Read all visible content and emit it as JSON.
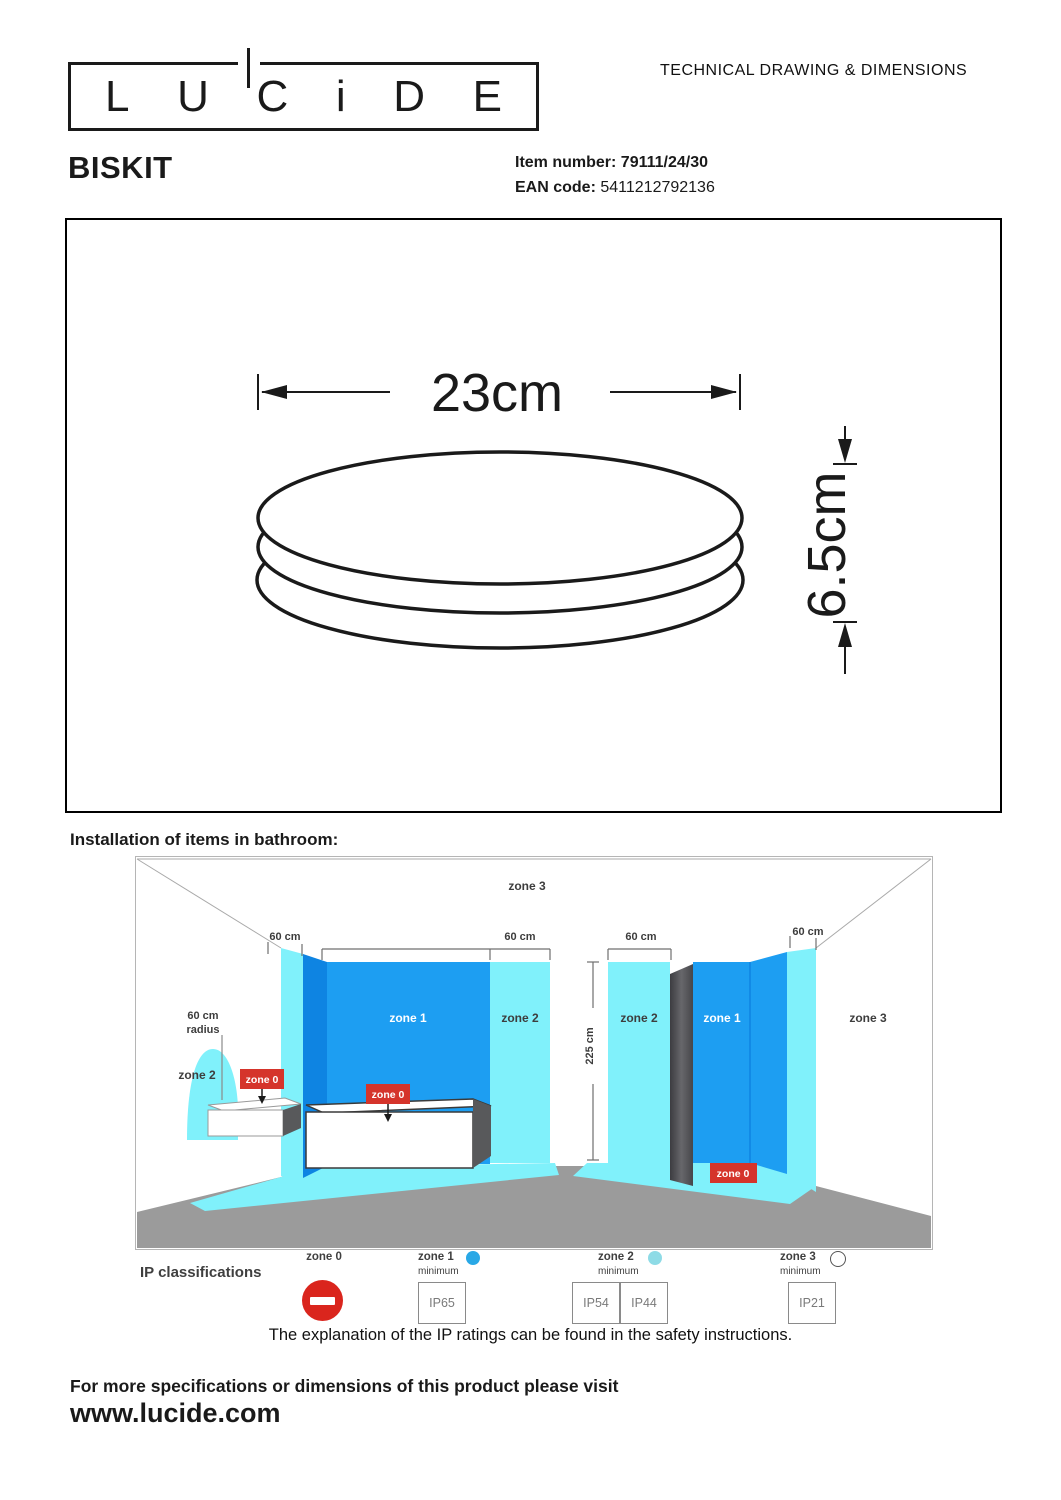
{
  "header": {
    "brand_letters": [
      "L",
      "U",
      "C",
      "i",
      "D",
      "E"
    ],
    "doc_title": "TECHNICAL DRAWING & DIMENSIONS",
    "product_name": "BISKIT",
    "item_number_label": "Item number:",
    "item_number_value": "79111/24/30",
    "ean_label": "EAN code:",
    "ean_value": "5411212792136"
  },
  "drawing": {
    "width_dim": "23cm",
    "height_dim": "6.5cm"
  },
  "bathroom": {
    "section_title": "Installation of items in bathroom:",
    "ceiling_zone": "zone 3",
    "left_wall_dim": "60 cm",
    "tub_zone2_dim": "60 cm",
    "shower_zone2_dim": "60 cm",
    "right_wall_dim": "60 cm",
    "room_height_dim": "225 cm",
    "radius_label_line1": "60 cm",
    "radius_label_line2": "radius",
    "sink_zone": "zone 2",
    "sink_badge": "zone 0",
    "tub_wall_zone": "zone 1",
    "tub_right_zone": "zone 2",
    "tub_badge": "zone 0",
    "shower_left_zone": "zone 2",
    "shower_wall_zone": "zone 1",
    "shower_badge": "zone 0",
    "right_wall_zone": "zone 3"
  },
  "ip_section": {
    "title": "IP classifications",
    "zones": [
      {
        "name": "zone 0",
        "minimum": "",
        "ratings": []
      },
      {
        "name": "zone 1",
        "minimum": "minimum",
        "ratings": [
          "IP65"
        ]
      },
      {
        "name": "zone 2",
        "minimum": "minimum",
        "ratings": [
          "IP54",
          "IP44"
        ]
      },
      {
        "name": "zone 3",
        "minimum": "minimum",
        "ratings": [
          "IP21"
        ]
      }
    ],
    "note": "The explanation of the IP ratings can be found in the safety instructions."
  },
  "footer": {
    "visit_line": "For more specifications or dimensions of this product please visit",
    "website": "www.lucide.com"
  },
  "colors": {
    "zone1_blue": "#1d9ef2",
    "zone1_blue_dark": "#0e84e2",
    "zone2_cyan": "#80f1fb",
    "floor_gray": "#9b9b9b",
    "shower_panel_gray": "#4a4a4e",
    "badge_red": "#d5342b",
    "prohibition_red": "#da251d",
    "legend_zone1_dot": "#29a8e6",
    "legend_zone2_dot": "#8edbe6"
  }
}
